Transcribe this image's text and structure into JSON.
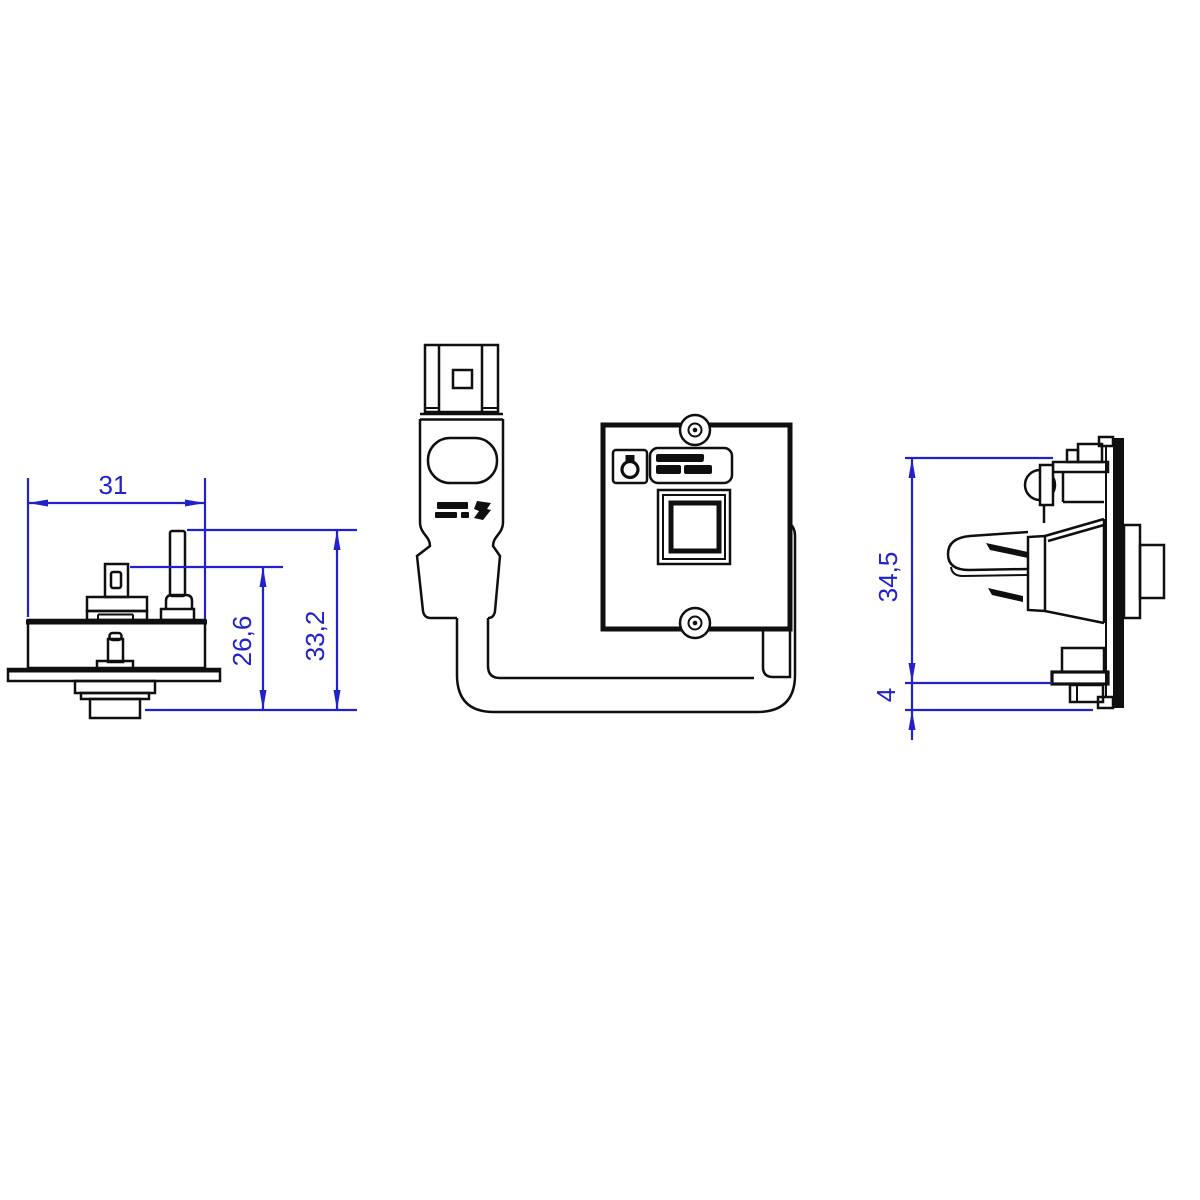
{
  "drawing": {
    "kind": "technical-drawing-3-views",
    "dimensions": {
      "width": "31",
      "bracket_height": "26,6",
      "overall_height": "33,2",
      "side_height": "34,5",
      "panel_thickness": "4"
    },
    "colors": {
      "dimension_blue": "#2121ce",
      "line_black": "#0f0f0f",
      "background": "#ffffff"
    },
    "icons": {
      "brand_badge": "lock-seal-icon",
      "screws": "screw-head-icon",
      "electrical_marks": "dc-rating-marks"
    }
  }
}
